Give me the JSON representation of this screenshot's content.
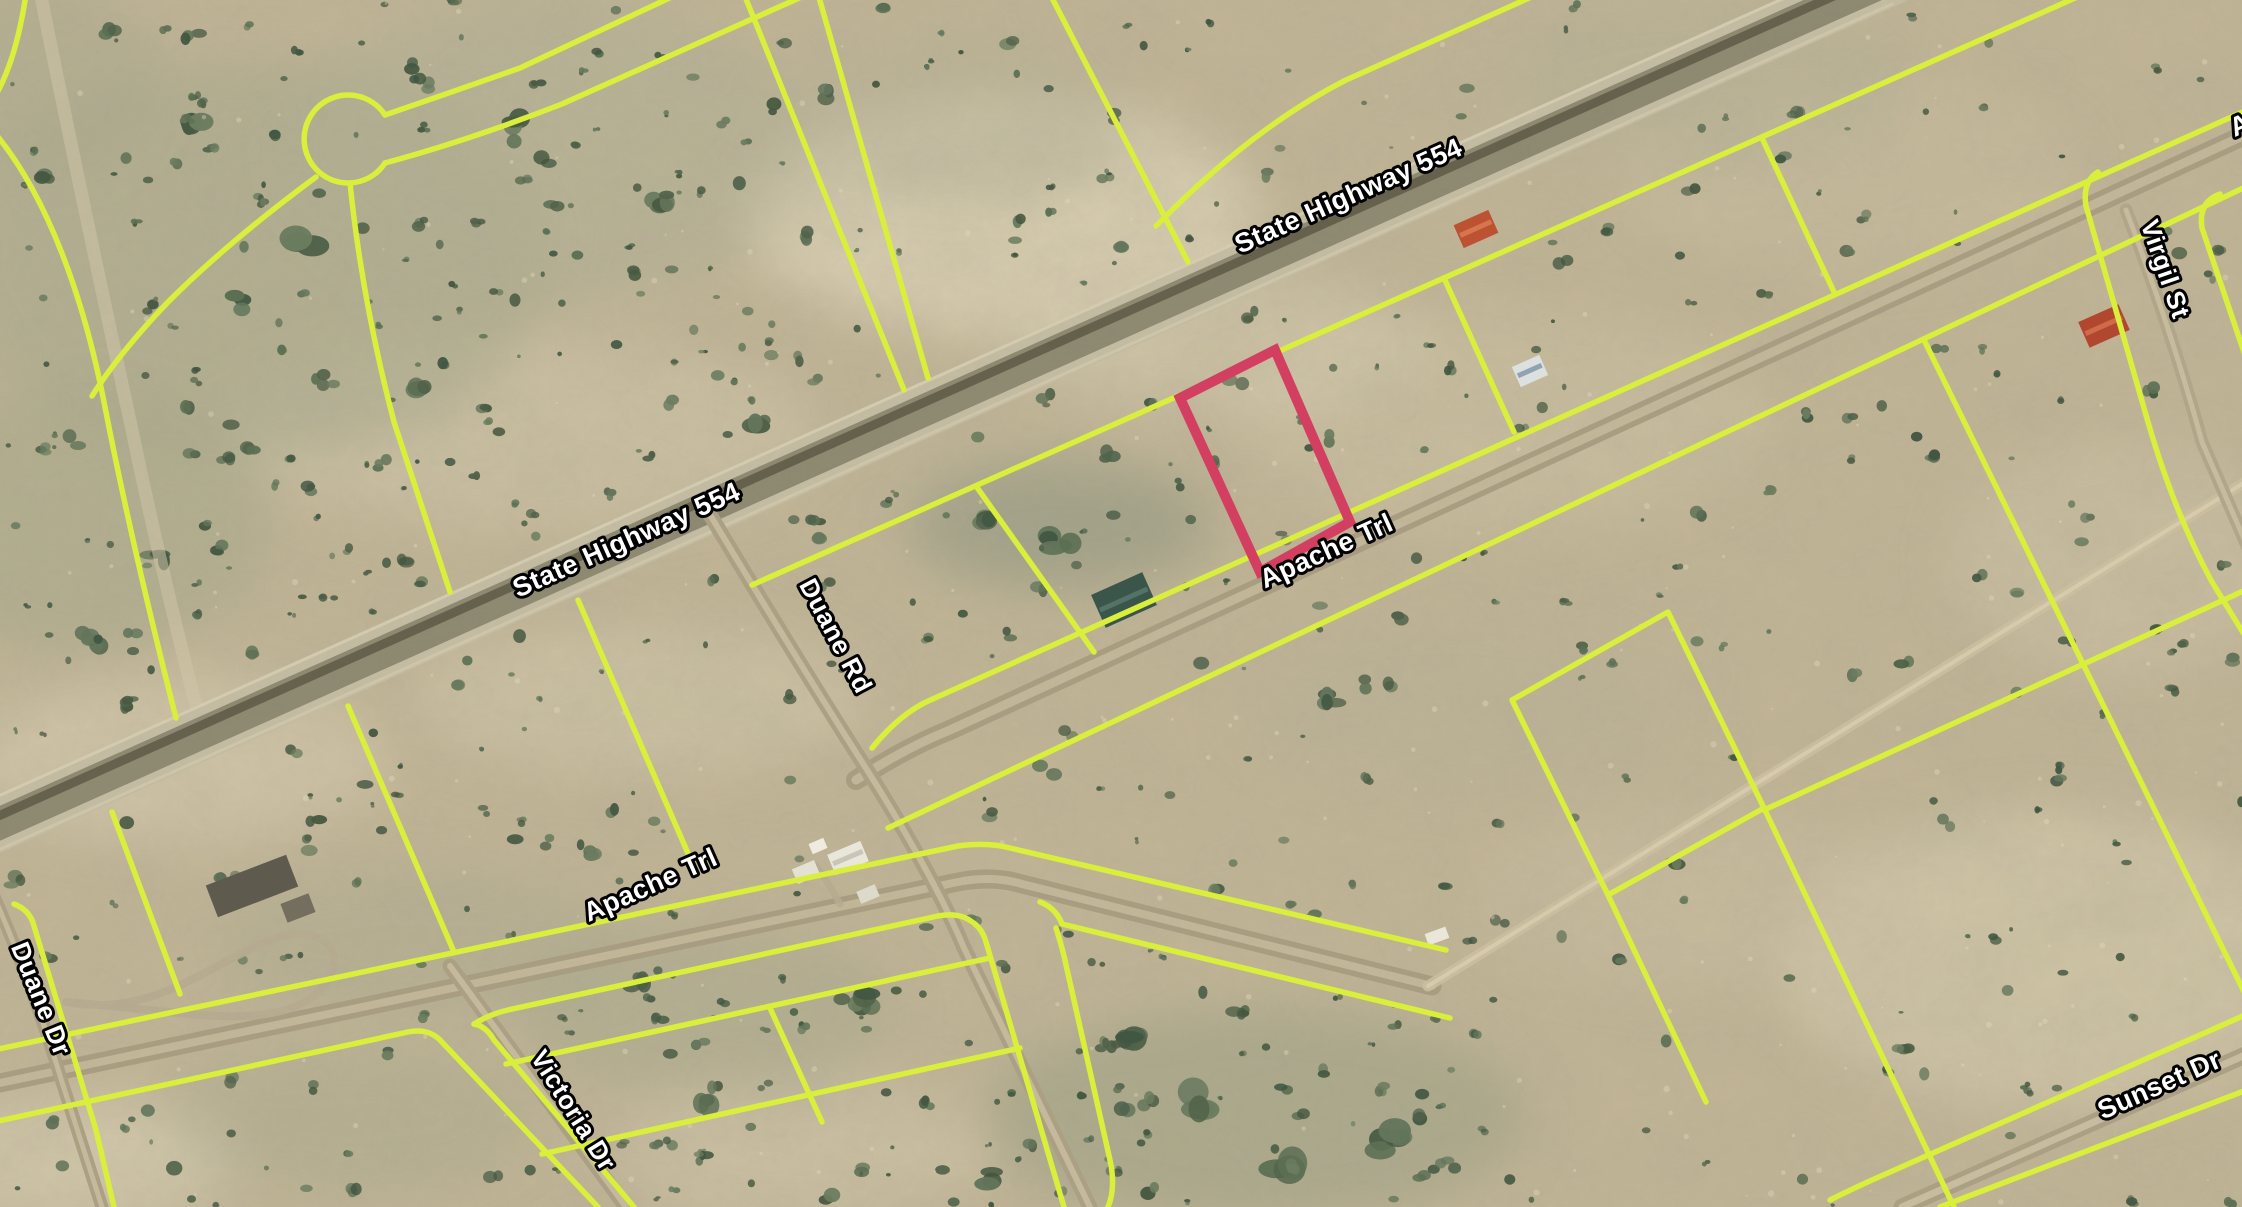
{
  "map": {
    "description": "satellite parcel map with highlighted lot",
    "colors": {
      "parcel_line": "#d9ef3b",
      "highlight_parcel": "#d23f60",
      "label_text": "#ffffff",
      "label_outline": "#000000",
      "terrain_base": "#c3b697"
    },
    "road_labels": [
      {
        "id": "state-highway-554-upper",
        "text": "State Highway 554",
        "x": 1352,
        "y": 204,
        "rot": -24,
        "size": 27
      },
      {
        "id": "state-highway-554-lower",
        "text": "State Highway 554",
        "x": 630,
        "y": 548,
        "rot": -24,
        "size": 27
      },
      {
        "id": "apache-trl-upper",
        "text": "Apache Trl",
        "x": 1330,
        "y": 559,
        "rot": -24.5,
        "size": 27
      },
      {
        "id": "apache-trl-lower",
        "text": "Apache Trl",
        "x": 654,
        "y": 893,
        "rot": -24,
        "size": 27
      },
      {
        "id": "apache-trl-clipped",
        "text": "Apache Trl",
        "x": 2300,
        "y": 108,
        "rot": -24,
        "size": 27
      },
      {
        "id": "duane-rd",
        "text": "Duane Rd",
        "x": 828,
        "y": 640,
        "rot": 62,
        "size": 26
      },
      {
        "id": "duane-dr",
        "text": "Duane Dr",
        "x": 33,
        "y": 1002,
        "rot": 68,
        "size": 26
      },
      {
        "id": "victoria-dr",
        "text": "Victoria Dr",
        "x": 566,
        "y": 1115,
        "rot": 58,
        "size": 26
      },
      {
        "id": "virgil-st",
        "text": "Virgil St",
        "x": 2157,
        "y": 272,
        "rot": 71,
        "size": 26
      },
      {
        "id": "sunset-dr",
        "text": "Sunset Dr",
        "x": 2163,
        "y": 1093,
        "rot": -24,
        "size": 27
      }
    ],
    "highlighted_parcel": {
      "name": "highlighted parcel boundary",
      "color": "#d23f60"
    }
  }
}
